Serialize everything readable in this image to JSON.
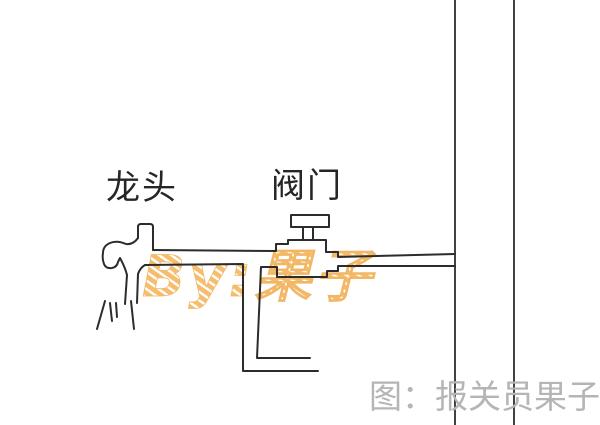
{
  "diagram": {
    "labels": {
      "faucet": "龙头",
      "valve": "阀门"
    },
    "watermark": "By:果子",
    "caption": "图：报关员果子",
    "icons": {
      "faucet": "faucet-tap-drawing",
      "valve": "gate-valve-drawing",
      "spray": "water-spray-lines",
      "walls": "wall-pipe-risers"
    },
    "colors": {
      "background": "#ffffff",
      "line": "#2c2c2c",
      "caption_text": "#b5b5b5",
      "watermark_orange": "#f5bd6e"
    }
  }
}
